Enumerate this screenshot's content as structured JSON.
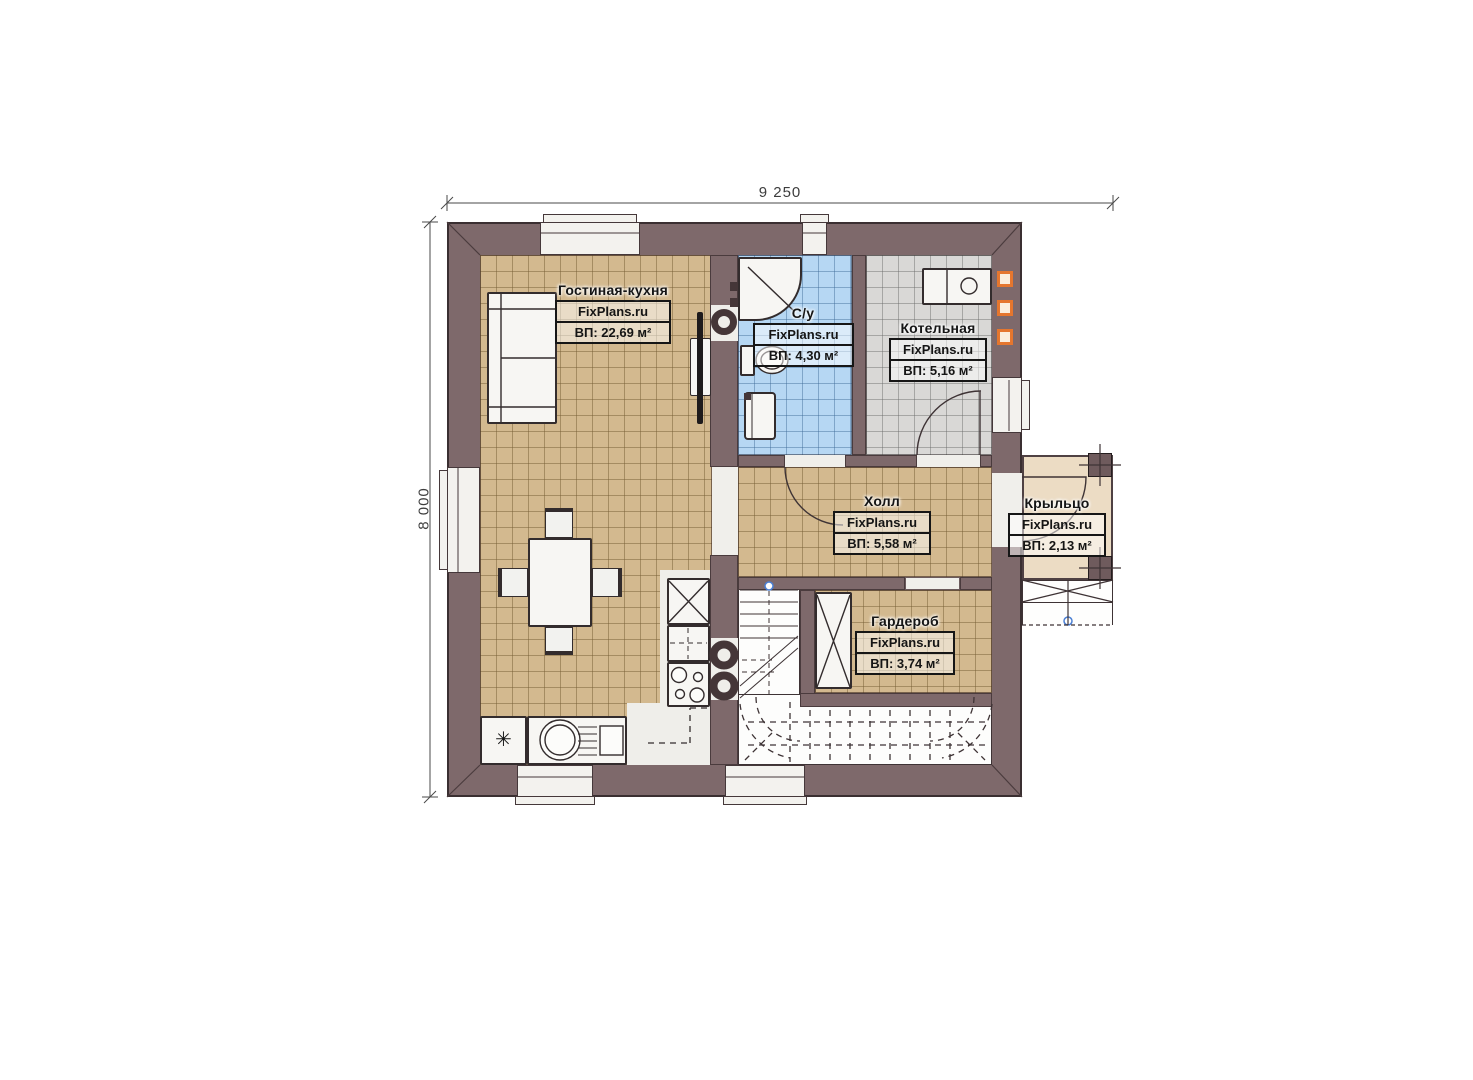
{
  "plan": {
    "watermark": "FixPlans.ru",
    "dimensions": {
      "width_label": "9 250",
      "height_label": "8 000"
    },
    "rooms": {
      "living": {
        "name": "Гостиная-кухня",
        "area": "ВП: 22,69 м²"
      },
      "bathroom": {
        "name": "С/у",
        "area": "ВП: 4,30 м²"
      },
      "boiler": {
        "name": "Котельная",
        "area": "ВП: 5,16 м²"
      },
      "hall": {
        "name": "Холл",
        "area": "ВП: 5,58 м²"
      },
      "wardrobe": {
        "name": "Гардероб",
        "area": "ВП: 3,74 м²"
      },
      "porch": {
        "name": "Крыльцо",
        "area": "ВП: 2,13 м²"
      }
    },
    "icons": {
      "fridge": "✳"
    },
    "colors": {
      "wall": "#7e696b",
      "floor_tan": "#d3b98f",
      "floor_blue": "#b6d7f3",
      "floor_gray": "#d9d8d6",
      "porch": "#ecdcc4",
      "accent_orange": "#e5762e",
      "marker_blue": "#4a7fd4"
    }
  }
}
